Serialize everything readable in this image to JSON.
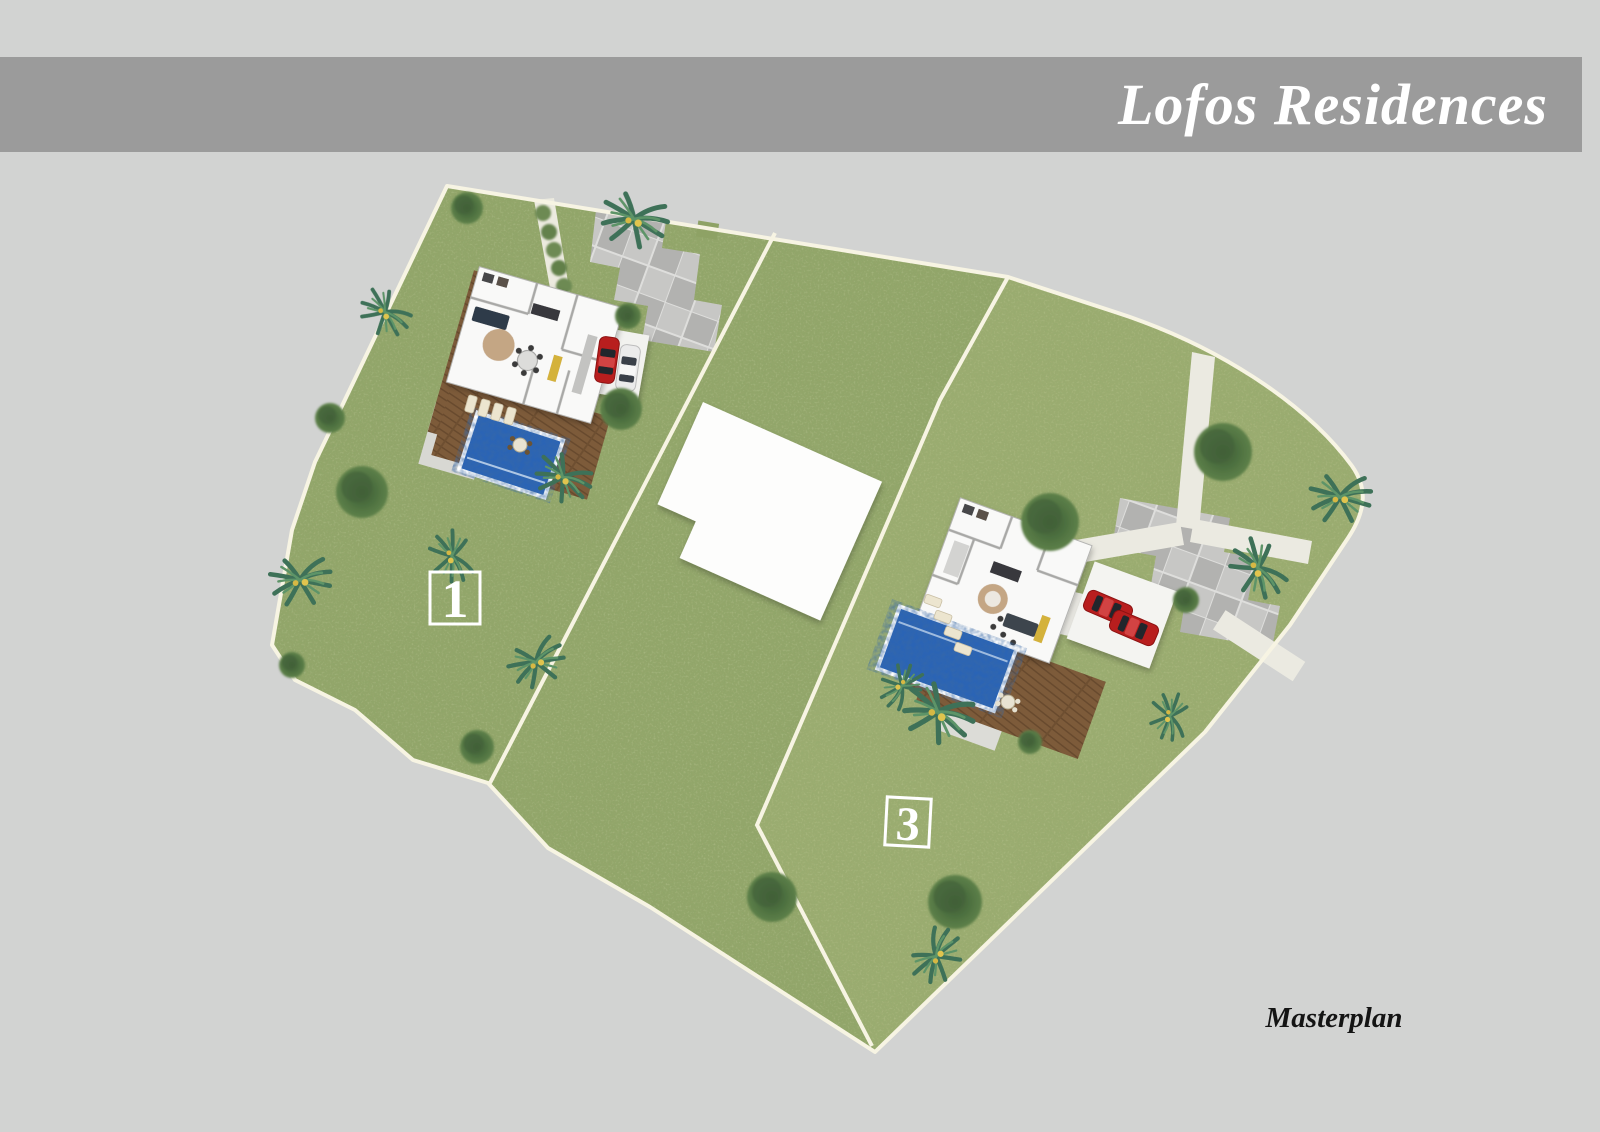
{
  "header": {
    "title": "Lofos Residences",
    "bar_color": "#9b9b9b",
    "text_color": "#ffffff"
  },
  "caption": {
    "label": "Masterplan"
  },
  "page": {
    "background_color": "#d2d3d2"
  },
  "masterplan": {
    "plots": [
      {
        "label": "1",
        "marker": "white-outlined-square",
        "features": [
          "villa-floor-plan",
          "wood-deck",
          "swimming-pool",
          "stone-patio",
          "parking-red-and-white-car",
          "paved-driveway",
          "hedge-path",
          "garden-trees",
          "palm-trees"
        ]
      },
      {
        "label": "3",
        "marker": "white-outlined-square",
        "features": [
          "villa-floor-plan",
          "wood-deck",
          "swimming-pool",
          "parking-two-red-cars",
          "paved-driveway",
          "access-roads",
          "garden-trees",
          "palm-trees"
        ]
      }
    ],
    "colors": {
      "grass": "#94a66b",
      "boundary_line": "#f7f4e3",
      "pool_water": "#2a64b6",
      "deck_wood": "#7d5b3a",
      "paving": "#bdbdbb",
      "building": "#f9f9f8",
      "car_red": "#b81e1e",
      "car_white": "#ebebeb"
    }
  }
}
